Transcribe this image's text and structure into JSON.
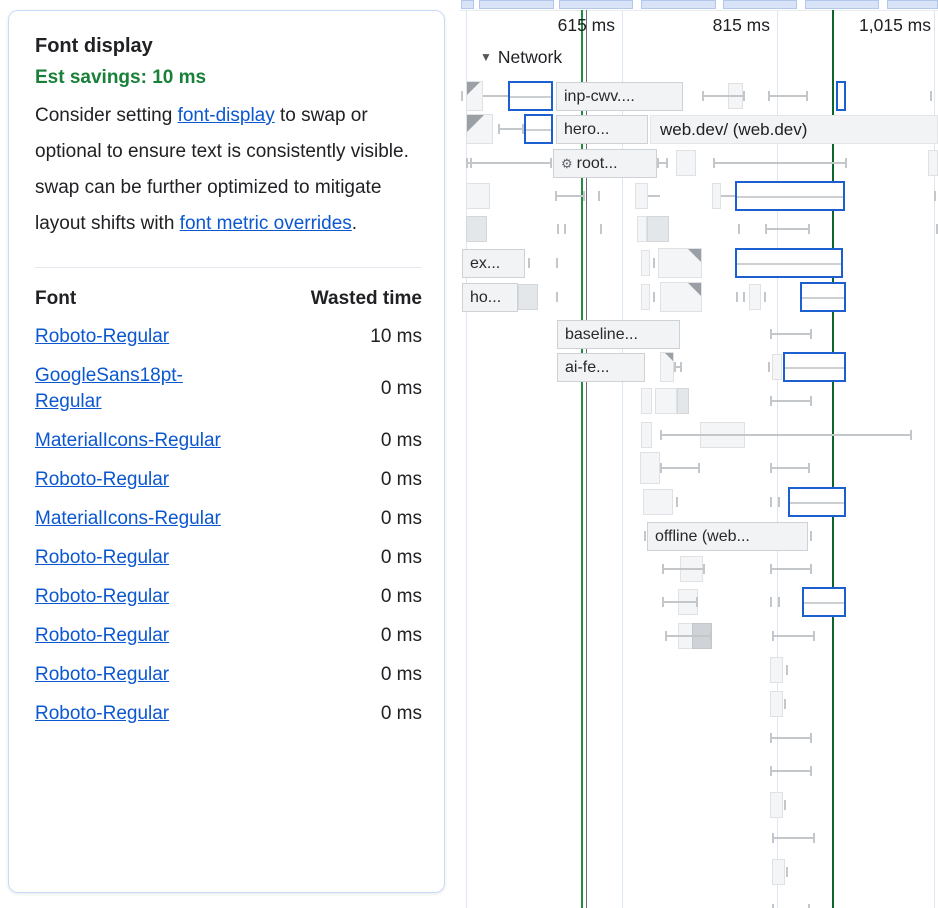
{
  "colors": {
    "accent": "#1b5fd0",
    "link": "#0b57d0",
    "savings": "#188038",
    "grid": "#dde7f3",
    "whisker": "#c4c7ca",
    "chip_bg": "#f1f3f4",
    "chip_border": "#ced2d6",
    "box_bg": "#f4f5f6",
    "box_border": "#dfe1e4",
    "fold": "#9aa0a6",
    "card_border": "#c9dbfb",
    "minimap_bg": "#d8e3f8",
    "minimap_border": "#b3c6ec",
    "marker_green": "#1e8e3e",
    "marker_grey": "#6b6f73",
    "marker_dark_green": "#0d652d"
  },
  "audit": {
    "title": "Font display",
    "savings": "Est savings: 10 ms",
    "description": {
      "p1": "Consider setting ",
      "link1": "font-display",
      "p2": " to swap or optional to ensure text is consistently visible. swap can be further optimized to mitigate layout shifts with ",
      "link2": "font metric overrides",
      "p3": "."
    },
    "table": {
      "headers": [
        "Font",
        "Wasted time"
      ],
      "rows": [
        {
          "font": "Roboto-Regular",
          "time": "10 ms"
        },
        {
          "font": "GoogleSans18pt-Regular",
          "time": "0 ms"
        },
        {
          "font": "MaterialIcons-Regular",
          "time": "0 ms"
        },
        {
          "font": "Roboto-Regular",
          "time": "0 ms"
        },
        {
          "font": "MaterialIcons-Regular",
          "time": "0 ms"
        },
        {
          "font": "Roboto-Regular",
          "time": "0 ms"
        },
        {
          "font": "Roboto-Regular",
          "time": "0 ms"
        },
        {
          "font": "Roboto-Regular",
          "time": "0 ms"
        },
        {
          "font": "Roboto-Regular",
          "time": "0 ms"
        },
        {
          "font": "Roboto-Regular",
          "time": "0 ms"
        }
      ]
    }
  },
  "timeline": {
    "network_label": "Network",
    "ruler_labels": [
      {
        "text": "615 ms",
        "right": 155
      },
      {
        "text": "815 ms",
        "right": 310
      },
      {
        "text": "1,015 ms",
        "right": 471
      }
    ],
    "gridlines": [
      6,
      162,
      317,
      474
    ],
    "markers": [
      {
        "x": 121,
        "color_key": "marker_green"
      },
      {
        "x": 125.5,
        "color_key": "marker_grey"
      },
      {
        "x": 372,
        "color_key": "marker_dark_green"
      }
    ],
    "minimap_segments": [
      {
        "x": 1,
        "w": 13
      },
      {
        "x": 19,
        "w": 75
      },
      {
        "x": 99,
        "w": 74
      },
      {
        "x": 181,
        "w": 75
      },
      {
        "x": 263,
        "w": 74
      },
      {
        "x": 345,
        "w": 74
      },
      {
        "x": 427,
        "w": 51
      }
    ],
    "rows": [
      {
        "y": 80,
        "items": [
          {
            "t": "tick",
            "x": 1
          },
          {
            "t": "clip",
            "x": 6,
            "w": 17
          },
          {
            "t": "line",
            "x1": 23,
            "x2": 48
          },
          {
            "t": "blue",
            "x": 48,
            "w": 45
          },
          {
            "t": "chip",
            "x": 96,
            "w": 127,
            "label": "inp-cwv...."
          },
          {
            "t": "box",
            "x": 268,
            "w": 15
          },
          {
            "t": "whisker",
            "x1": 242,
            "x2": 285
          },
          {
            "t": "whisker",
            "x1": 308,
            "x2": 348
          },
          {
            "t": "blue",
            "x": 376,
            "w": 10,
            "nomid": true
          },
          {
            "t": "tick",
            "x": 470
          }
        ]
      },
      {
        "y": 113,
        "items": [
          {
            "t": "clip",
            "x": 6,
            "w": 27,
            "big": true
          },
          {
            "t": "whisker",
            "x1": 38,
            "x2": 64
          },
          {
            "t": "blue",
            "x": 64,
            "w": 29
          },
          {
            "t": "chip",
            "x": 96,
            "w": 92,
            "label": "hero..."
          },
          {
            "t": "band",
            "x": 190,
            "w": 288,
            "label": "web.dev/ (web.dev)"
          }
        ]
      },
      {
        "y": 147,
        "items": [
          {
            "t": "whisker",
            "x1": 6,
            "x2": 92
          },
          {
            "t": "tick",
            "x": 10
          },
          {
            "t": "chip",
            "x": 93,
            "w": 104,
            "label": "root...",
            "icon": "gear"
          },
          {
            "t": "whisker",
            "x1": 197,
            "x2": 208
          },
          {
            "t": "box",
            "x": 216,
            "w": 20
          },
          {
            "t": "whisker",
            "x1": 253,
            "x2": 387
          },
          {
            "t": "box",
            "x": 468,
            "w": 10
          }
        ]
      },
      {
        "y": 180,
        "items": [
          {
            "t": "box",
            "x": 6,
            "w": 24
          },
          {
            "t": "whisker",
            "x1": 95,
            "x2": 125
          },
          {
            "t": "tick",
            "x": 138
          },
          {
            "t": "box",
            "x": 175,
            "w": 13
          },
          {
            "t": "line",
            "x1": 188,
            "x2": 200
          },
          {
            "t": "box",
            "x": 252,
            "w": 9
          },
          {
            "t": "line",
            "x1": 261,
            "x2": 275
          },
          {
            "t": "blue",
            "x": 275,
            "w": 110
          },
          {
            "t": "tick",
            "x": 474
          }
        ]
      },
      {
        "y": 213,
        "items": [
          {
            "t": "box",
            "x": 6,
            "w": 21,
            "shade": "mid"
          },
          {
            "t": "tick",
            "x": 97
          },
          {
            "t": "tick",
            "x": 104
          },
          {
            "t": "tick",
            "x": 140
          },
          {
            "t": "box",
            "x": 177,
            "w": 10
          },
          {
            "t": "box",
            "x": 187,
            "w": 22,
            "shade": "mid"
          },
          {
            "t": "tick",
            "x": 278
          },
          {
            "t": "whisker",
            "x1": 305,
            "x2": 350
          },
          {
            "t": "tick",
            "x": 476
          }
        ]
      },
      {
        "y": 247,
        "items": [
          {
            "t": "chip",
            "x": 2,
            "w": 63,
            "label": "ex..."
          },
          {
            "t": "tick",
            "x": 68
          },
          {
            "t": "tick",
            "x": 96
          },
          {
            "t": "box",
            "x": 181,
            "w": 9
          },
          {
            "t": "tick",
            "x": 193
          },
          {
            "t": "fold",
            "x": 198,
            "w": 44
          },
          {
            "t": "blue",
            "x": 275,
            "w": 108
          }
        ]
      },
      {
        "y": 281,
        "items": [
          {
            "t": "chip",
            "x": 2,
            "w": 56,
            "label": "ho..."
          },
          {
            "t": "box",
            "x": 58,
            "w": 20,
            "shade": "mid"
          },
          {
            "t": "tick",
            "x": 96
          },
          {
            "t": "box",
            "x": 181,
            "w": 9
          },
          {
            "t": "tick",
            "x": 193
          },
          {
            "t": "fold",
            "x": 200,
            "w": 42
          },
          {
            "t": "tick",
            "x": 276
          },
          {
            "t": "tick",
            "x": 283
          },
          {
            "t": "box",
            "x": 289,
            "w": 12
          },
          {
            "t": "tick",
            "x": 304
          },
          {
            "t": "blue",
            "x": 340,
            "w": 46
          }
        ]
      },
      {
        "y": 318,
        "items": [
          {
            "t": "chip",
            "x": 97,
            "w": 123,
            "label": "baseline..."
          },
          {
            "t": "whisker",
            "x1": 310,
            "x2": 352
          }
        ]
      },
      {
        "y": 351,
        "items": [
          {
            "t": "chip",
            "x": 97,
            "w": 88,
            "label": "ai-fe..."
          },
          {
            "t": "fold",
            "x": 200,
            "w": 14,
            "small": true
          },
          {
            "t": "whisker",
            "x1": 214,
            "x2": 222
          },
          {
            "t": "tick",
            "x": 308
          },
          {
            "t": "box",
            "x": 312,
            "w": 10
          },
          {
            "t": "blue",
            "x": 323,
            "w": 63
          }
        ]
      },
      {
        "y": 385,
        "items": [
          {
            "t": "box",
            "x": 181,
            "w": 11
          },
          {
            "t": "box",
            "x": 195,
            "w": 22
          },
          {
            "t": "box",
            "x": 217,
            "w": 12,
            "shade": "mid"
          },
          {
            "t": "whisker",
            "x1": 310,
            "x2": 352
          }
        ]
      },
      {
        "y": 419,
        "items": [
          {
            "t": "box",
            "x": 181,
            "w": 11
          },
          {
            "t": "box",
            "x": 240,
            "w": 45
          },
          {
            "t": "whisker",
            "x1": 200,
            "x2": 452
          }
        ]
      },
      {
        "y": 452,
        "items": [
          {
            "t": "box",
            "x": 180,
            "w": 20,
            "tall": true
          },
          {
            "t": "whisker",
            "x1": 200,
            "x2": 240
          },
          {
            "t": "whisker",
            "x1": 310,
            "x2": 350
          }
        ]
      },
      {
        "y": 486,
        "items": [
          {
            "t": "box",
            "x": 183,
            "w": 30
          },
          {
            "t": "tick",
            "x": 216
          },
          {
            "t": "tick",
            "x": 310
          },
          {
            "t": "tick",
            "x": 318
          },
          {
            "t": "blue",
            "x": 328,
            "w": 58
          }
        ]
      },
      {
        "y": 520,
        "items": [
          {
            "t": "tick",
            "x": 184
          },
          {
            "t": "chip",
            "x": 187,
            "w": 161,
            "label": "offline (web..."
          },
          {
            "t": "tick",
            "x": 350
          }
        ]
      },
      {
        "y": 553,
        "items": [
          {
            "t": "box",
            "x": 220,
            "w": 23
          },
          {
            "t": "whisker",
            "x1": 202,
            "x2": 245
          },
          {
            "t": "whisker",
            "x1": 310,
            "x2": 352
          }
        ]
      },
      {
        "y": 586,
        "items": [
          {
            "t": "box",
            "x": 218,
            "w": 20
          },
          {
            "t": "whisker",
            "x1": 202,
            "x2": 238
          },
          {
            "t": "tick",
            "x": 310
          },
          {
            "t": "tick",
            "x": 318
          },
          {
            "t": "blue",
            "x": 342,
            "w": 44
          }
        ]
      },
      {
        "y": 620,
        "items": [
          {
            "t": "box",
            "x": 218,
            "w": 34
          },
          {
            "t": "box",
            "x": 232,
            "w": 20,
            "shade": "dark"
          },
          {
            "t": "whisker",
            "x1": 205,
            "x2": 252
          },
          {
            "t": "whisker",
            "x1": 312,
            "x2": 355
          }
        ]
      },
      {
        "y": 654,
        "items": [
          {
            "t": "box",
            "x": 310,
            "w": 13
          },
          {
            "t": "tick",
            "x": 326
          }
        ]
      },
      {
        "y": 688,
        "items": [
          {
            "t": "box",
            "x": 310,
            "w": 13
          },
          {
            "t": "tick",
            "x": 324
          }
        ]
      },
      {
        "y": 722,
        "items": [
          {
            "t": "whisker",
            "x1": 310,
            "x2": 352
          }
        ]
      },
      {
        "y": 755,
        "items": [
          {
            "t": "whisker",
            "x1": 310,
            "x2": 352
          }
        ]
      },
      {
        "y": 789,
        "items": [
          {
            "t": "box",
            "x": 310,
            "w": 13
          },
          {
            "t": "tick",
            "x": 324
          }
        ]
      },
      {
        "y": 822,
        "items": [
          {
            "t": "whisker",
            "x1": 312,
            "x2": 355
          }
        ]
      },
      {
        "y": 856,
        "items": [
          {
            "t": "box",
            "x": 312,
            "w": 13
          },
          {
            "t": "tick",
            "x": 326
          }
        ]
      },
      {
        "y": 893,
        "items": [
          {
            "t": "tick",
            "x": 312
          },
          {
            "t": "tick",
            "x": 348
          }
        ]
      }
    ]
  }
}
